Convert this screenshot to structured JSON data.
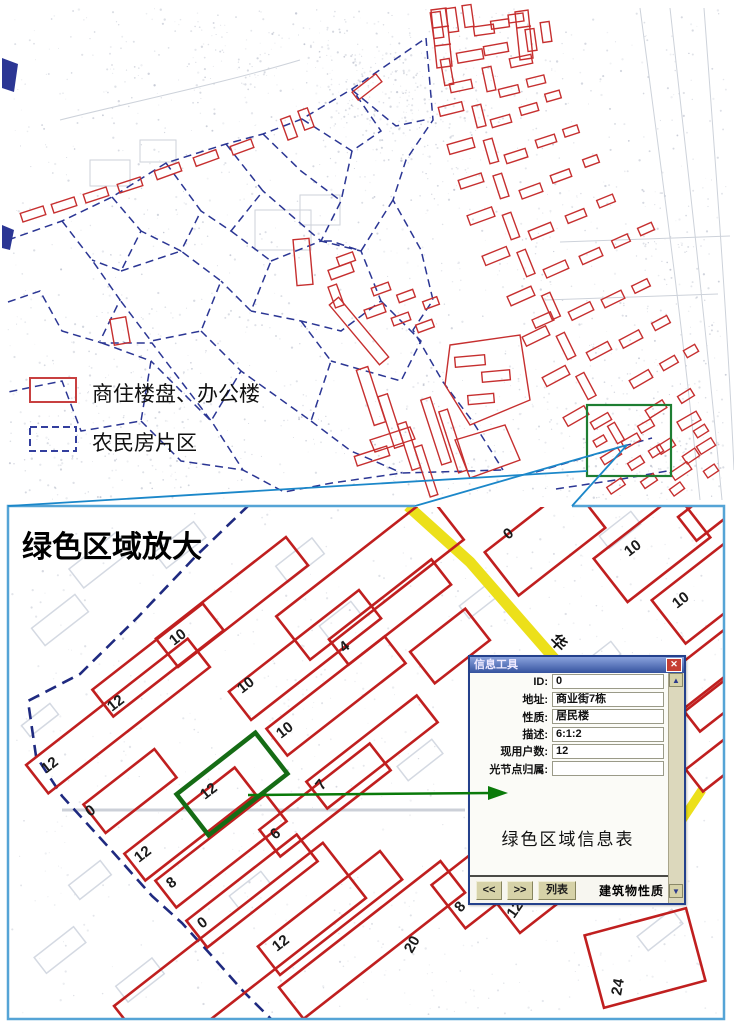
{
  "overview_map": {
    "legend": {
      "items": [
        {
          "symbol": "red-rect",
          "label": "商住楼盘、办公楼"
        },
        {
          "symbol": "blue-dashed-rect",
          "label": "农民房片区"
        }
      ]
    }
  },
  "zoom_panel": {
    "title": "绿色区域放大",
    "road_label": "华",
    "building_labels": [
      {
        "text": "10",
        "x": 174,
        "y": 646,
        "rot": -38
      },
      {
        "text": "10",
        "x": 242,
        "y": 694,
        "rot": -38
      },
      {
        "text": "12",
        "x": 112,
        "y": 712,
        "rot": -38
      },
      {
        "text": "4",
        "x": 344,
        "y": 653,
        "rot": -38
      },
      {
        "text": "10",
        "x": 281,
        "y": 739,
        "rot": -38
      },
      {
        "text": "0",
        "x": 508,
        "y": 540,
        "rot": -38
      },
      {
        "text": "10",
        "x": 629,
        "y": 557,
        "rot": -38
      },
      {
        "text": "10",
        "x": 677,
        "y": 609,
        "rot": -38
      },
      {
        "text": "12",
        "x": 46,
        "y": 774,
        "rot": -38
      },
      {
        "text": "0",
        "x": 90,
        "y": 817,
        "rot": -38
      },
      {
        "text": "12",
        "x": 139,
        "y": 863,
        "rot": -38
      },
      {
        "text": "8",
        "x": 171,
        "y": 889,
        "rot": -38
      },
      {
        "text": "0",
        "x": 202,
        "y": 929,
        "rot": -38
      },
      {
        "text": "12",
        "x": 205,
        "y": 800,
        "rot": -38
      },
      {
        "text": "6",
        "x": 275,
        "y": 840,
        "rot": -38
      },
      {
        "text": "7",
        "x": 322,
        "y": 791,
        "rot": -50
      },
      {
        "text": "12",
        "x": 277,
        "y": 952,
        "rot": -38
      },
      {
        "text": "20",
        "x": 412,
        "y": 954,
        "rot": -60
      },
      {
        "text": "8",
        "x": 461,
        "y": 913,
        "rot": -50
      },
      {
        "text": "12",
        "x": 514,
        "y": 919,
        "rot": -55
      },
      {
        "text": "24",
        "x": 621,
        "y": 996,
        "rot": -80
      }
    ]
  },
  "info_dialog": {
    "title": "信息工具",
    "close_glyph": "✕",
    "fields": [
      {
        "label": "ID:",
        "value": "0"
      },
      {
        "label": "地址:",
        "value": "商业街7栋"
      },
      {
        "label": "性质:",
        "value": "居民楼"
      },
      {
        "label": "描述:",
        "value": "6:1:2"
      },
      {
        "label": "现用户数:",
        "value": "12"
      },
      {
        "label": "光节点归属:",
        "value": ""
      }
    ],
    "note": "绿色区域信息表",
    "buttons": {
      "prev": "<<",
      "next": ">>",
      "list": "列表"
    },
    "status": "建筑物性质",
    "scroll_up_glyph": "▲",
    "scroll_down_glyph": "▼"
  },
  "colors": {
    "overview_building_red": "#c62f2f",
    "zoom_building_red": "#c01f1f",
    "farmer_boundary_navy": "#2b3694",
    "highlight_green": "#1e7e32",
    "selected_building_green": "#156c15",
    "arrow_green": "#0a7a0a",
    "road_yellow": "#ece01a",
    "panel_border_blue": "#55a4d6",
    "leader_line_blue": "#1b87c9",
    "dialog_titlebar_blue": "#35539e",
    "dialog_button_tan": "#d6d2a8",
    "close_button_red": "#c53f33"
  }
}
